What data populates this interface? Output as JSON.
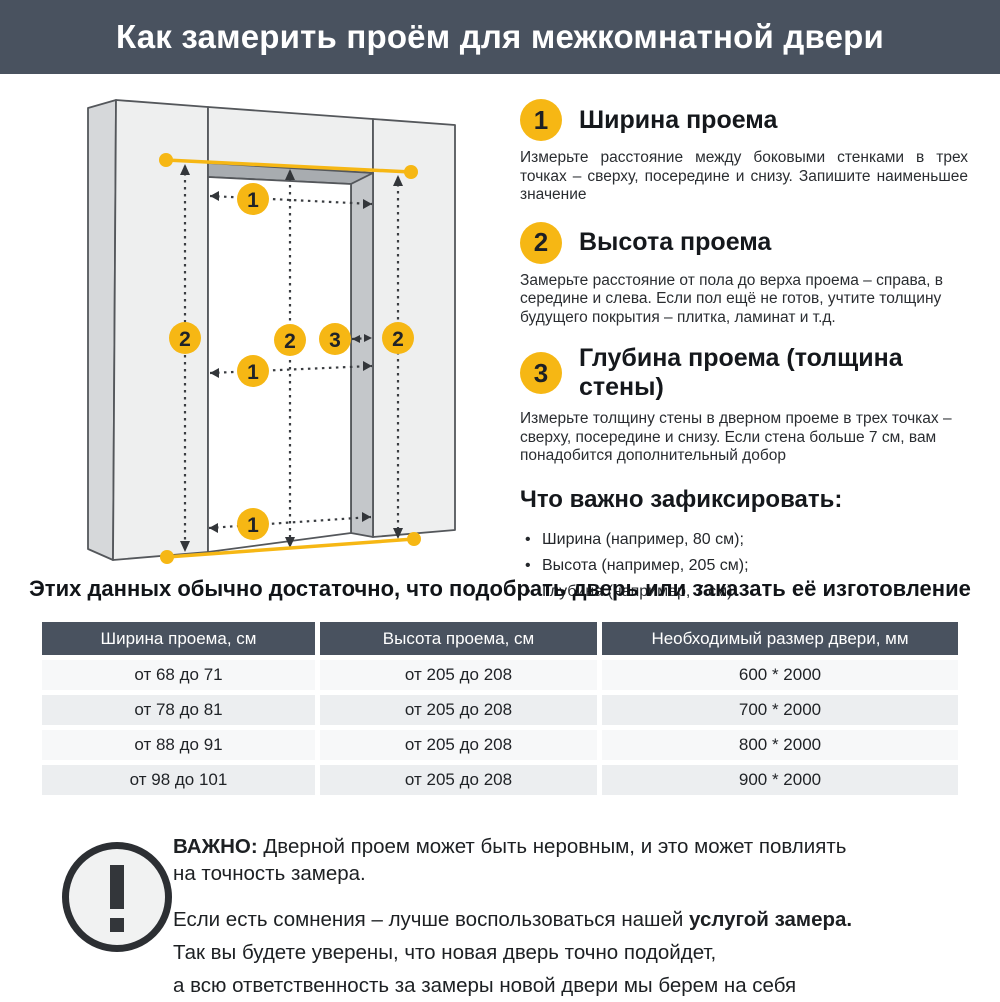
{
  "header": {
    "title": "Как замерить проём для межкомнатной двери"
  },
  "colors": {
    "accent_yellow": "#F6B714",
    "header_bg": "#49525F",
    "row_light": "#F7F8F9",
    "row_dark": "#ECEEF0"
  },
  "diagram": {
    "description": "isometric wall with door opening, measurement arrows",
    "badges": {
      "width": "1",
      "height": "2",
      "depth": "3"
    }
  },
  "steps": [
    {
      "number": "1",
      "title": "Ширина проема",
      "body": "Измерьте расстояние между боковыми стенками в трех точках – сверху, посередине и снизу. Запишите наименьшее значение"
    },
    {
      "number": "2",
      "title": "Высота проема",
      "body": "Замерьте расстояние от пола до верха проема – справа, в середине и слева. Если пол ещё не готов, учтите толщину будущего покрытия – плитка, ламинат и т.д."
    },
    {
      "number": "3",
      "title": "Глубина проема (толщина стены)",
      "body": "Измерьте толщину стены в дверном проеме в трех точках – сверху, посередине и снизу. Если стена больше 7 см, вам понадобится дополнительный добор"
    }
  ],
  "fixate": {
    "title": "Что важно зафиксировать:",
    "items": [
      "Ширина (например, 80 см);",
      "Высота (например, 205 см);",
      "Глубина (например, 7 см)"
    ]
  },
  "lead": "Этих данных обычно достаточно, что подобрать дверь или заказать её изготовление",
  "table": {
    "headers": [
      "Ширина проема, см",
      "Высота проема, см",
      "Необходимый размер двери, мм"
    ],
    "rows": [
      [
        "от 68 до 71",
        "от 205 до 208",
        "600 * 2000"
      ],
      [
        "от 78 до 81",
        "от 205 до 208",
        "700 * 2000"
      ],
      [
        "от 88 до 91",
        "от 205 до 208",
        "800 * 2000"
      ],
      [
        "от 98 до 101",
        "от 205 до 208",
        "900 * 2000"
      ]
    ]
  },
  "warning": {
    "p1_line1_bold": "ВАЖНО:",
    "p1_line1_rest": "Дверной проем может быть неровным, и это может повлиять",
    "p1_line2": "на точность замера.",
    "p2_line1_rest": "Если есть сомнения – лучше воспользоваться нашей",
    "p2_line1_bold": "услугой замера.",
    "p2_line2": "Так вы будете уверены, что новая дверь точно подойдет,",
    "p2_line3": "а всю ответственность за замеры новой двери мы берем на себя"
  }
}
